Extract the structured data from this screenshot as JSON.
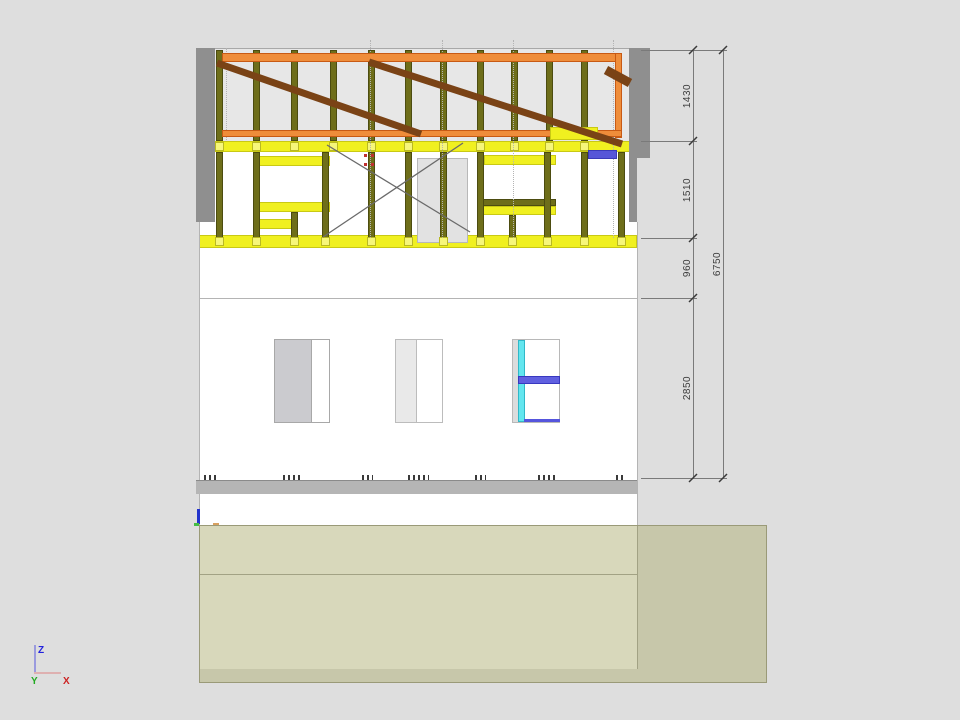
{
  "view": {
    "name": "cad-elevation-section-view"
  },
  "dimensions": {
    "right_chain": [
      {
        "label": "1430"
      },
      {
        "label": "1510"
      },
      {
        "label": "960"
      },
      {
        "label": "2850"
      }
    ],
    "overall": {
      "label": "6750"
    }
  },
  "axis": {
    "z": "Z",
    "y": "Y",
    "x": "X"
  },
  "colors": {
    "background": "#dedede",
    "roof_panel": "#e7e7e7",
    "stud_olive": "#6e6e1a",
    "beam_orange": "#ef8d3a",
    "brace_brown": "#7a4316",
    "plate_yellow": "#f0f020",
    "gray_strip": "#8f8f8f",
    "door_gray": "#e2e2e2",
    "terrain_light": "#d8d8bb",
    "terrain_dark": "#c7c7aa",
    "foundation_gray": "#b5b5b5",
    "accent_blue": "#5656d8",
    "accent_cyan": "#63e6ef",
    "axis_z": "#2222dd",
    "axis_y": "#22aa22",
    "axis_x": "#cc2222"
  },
  "drawing": {
    "studs_top": [
      216,
      253,
      291,
      330,
      368,
      405,
      440,
      477,
      511,
      546,
      581
    ],
    "studs_wall": [
      216,
      253,
      322,
      368,
      405,
      440,
      477,
      544,
      581,
      618
    ],
    "feet_bottom": [
      216,
      253,
      291,
      322,
      368,
      405,
      440,
      477,
      509,
      544,
      581,
      618
    ],
    "dotted_lines": [
      {
        "x": 226,
        "y1": 48,
        "y2": 140
      },
      {
        "x": 370,
        "y1": 40,
        "y2": 238
      },
      {
        "x": 442,
        "y1": 40,
        "y2": 238
      },
      {
        "x": 513,
        "y1": 40,
        "y2": 238
      },
      {
        "x": 613,
        "y1": 40,
        "y2": 238
      }
    ],
    "braces": [
      {
        "x1": 217,
        "y1": 63,
        "x2": 421,
        "y2": 134,
        "w": 7
      },
      {
        "x1": 369,
        "y1": 62,
        "x2": 622,
        "y2": 144,
        "w": 7
      },
      {
        "x1": 606,
        "y1": 70,
        "x2": 630,
        "y2": 83,
        "w": 9
      }
    ],
    "cross_lines": [
      {
        "x1": 323,
        "y1": 237,
        "x2": 463,
        "y2": 143
      },
      {
        "x1": 327,
        "y1": 145,
        "x2": 470,
        "y2": 232
      }
    ],
    "dim_ticks": [
      {
        "x": 693,
        "y": 50
      },
      {
        "x": 693,
        "y": 141
      },
      {
        "x": 693,
        "y": 238
      },
      {
        "x": 693,
        "y": 298
      },
      {
        "x": 693,
        "y": 478
      },
      {
        "x": 723,
        "y": 50
      },
      {
        "x": 723,
        "y": 478
      }
    ],
    "red_dots": [
      {
        "x": 633,
        "y": 90
      },
      {
        "x": 633,
        "y": 105
      },
      {
        "x": 633,
        "y": 120
      },
      {
        "x": 630,
        "y": 140
      },
      {
        "x": 364,
        "y": 154
      },
      {
        "x": 371,
        "y": 154
      },
      {
        "x": 364,
        "y": 163
      },
      {
        "x": 371,
        "y": 163
      },
      {
        "x": 537,
        "y": 378
      }
    ],
    "clipped_dim_marks": [
      {
        "x": 204,
        "w": 12
      },
      {
        "x": 283,
        "w": 20
      },
      {
        "x": 362,
        "w": 11
      },
      {
        "x": 408,
        "w": 21
      },
      {
        "x": 475,
        "w": 11
      },
      {
        "x": 538,
        "w": 18
      },
      {
        "x": 616,
        "w": 10
      }
    ]
  }
}
